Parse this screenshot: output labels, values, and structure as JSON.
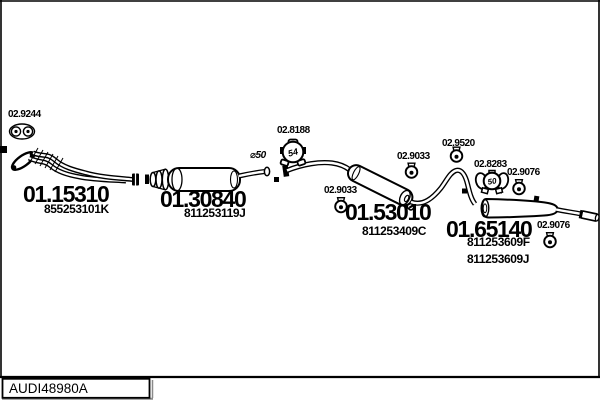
{
  "footer": {
    "catalog_code": "AUDI48980A"
  },
  "parts": {
    "front_pipe": {
      "code": "01.15310",
      "oem": "855253101K"
    },
    "center_silencer": {
      "code": "01.30840",
      "oem": "811253119J"
    },
    "mid_silencer": {
      "code": "01.53010",
      "oem": "811253409C"
    },
    "rear_silencer": {
      "code": "01.65140",
      "oem_f": "811253609F",
      "oem_j": "811253609J"
    }
  },
  "accessories": {
    "front_gasket": "02.9244",
    "mid_clamp": "02.8188",
    "mid_clamp_size": "54",
    "pipe_diameter": "⌀50",
    "hanger_mid_left": "02.9033",
    "hanger_mid_right": "02.9033",
    "hanger_rear_top": "02.9520",
    "rear_clamp": "02.8283",
    "rear_clamp_size": "50",
    "hanger_rear_upper": "02.9076",
    "hanger_rear_lower": "02.9076"
  },
  "colors": {
    "ink": "#000000",
    "background": "#ffffff",
    "shadow": "#8a8a8a"
  }
}
